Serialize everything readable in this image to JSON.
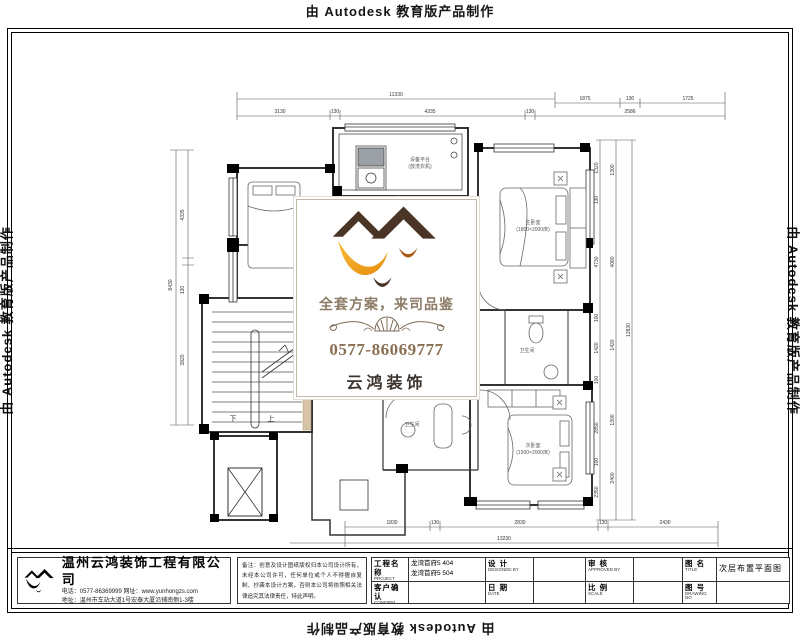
{
  "watermark": {
    "text": "由 Autodesk 教育版产品制作"
  },
  "logo_box": {
    "slogan": "全套方案，来司品鉴",
    "phone": "0577-86069777",
    "brand": "云鸿装饰"
  },
  "plan": {
    "rooms": {
      "platform": "设备平台",
      "platform_sub": "(放洗衣机)",
      "master": "主卧室",
      "master_sub": "(1800×2000床)",
      "bed2": "次卧室",
      "bed2_sub": "(1500×2000床)",
      "bath1": "卫生间",
      "bath2": "卫生间"
    },
    "stair": {
      "up": "上",
      "down": "下"
    },
    "dims": {
      "top_overall": "11330",
      "top_right": [
        "1875",
        "130",
        "1725"
      ],
      "top_row2": [
        "3130",
        "130",
        "4335",
        "130",
        "2586"
      ],
      "left_chain": [
        "4335",
        "130",
        "3820"
      ],
      "left_overall": "8430",
      "right_chain": [
        "1320",
        "130",
        "4730",
        "100",
        "1420",
        "100",
        "2850",
        "100",
        "2350"
      ],
      "right_chain2": [
        "1300",
        "4080",
        "1420",
        "1300",
        "2400"
      ],
      "right_overall": "12830",
      "bottom_chain": [
        "1830",
        "130",
        "2830",
        "130",
        "2430"
      ],
      "bottom_overall": "13230"
    }
  },
  "title_block": {
    "company": {
      "name": "温州云鸿装饰工程有限公司",
      "phone_line": "电话：0577-86369999  网址：www.yunhongzs.com",
      "address_line": "地址：温州市车站大道1号宏泰大厦沿铺南侧1-3楼"
    },
    "note": "备注：创意及设计图纸版权归本公司设计所有，未经本公司许可，任何单位或个人不得擅自复制、抄袭本设计方案，否则本公司将依照相关法律追究其法律责任，特此声明。",
    "fields": {
      "project_label": "工程名称",
      "project_en": "PROJECT",
      "project_value1": "龙湾首府5 404",
      "project_value2": "龙湾首府5 504",
      "confirm_label": "客户确认",
      "confirm_en": "CONFIRM",
      "design_label": "设 计",
      "design_en": "DESIGNED BY",
      "date_label": "日 期",
      "date_en": "DATE",
      "approve_label": "审 核",
      "approve_en": "APPROVED BY",
      "scale_label": "比 例",
      "scale_en": "SCALE",
      "title_label": "图 名",
      "title_en": "TITLE",
      "title_value": "次层布置平面图",
      "no_label": "图 号",
      "no_en": "DRAWING NO"
    }
  }
}
